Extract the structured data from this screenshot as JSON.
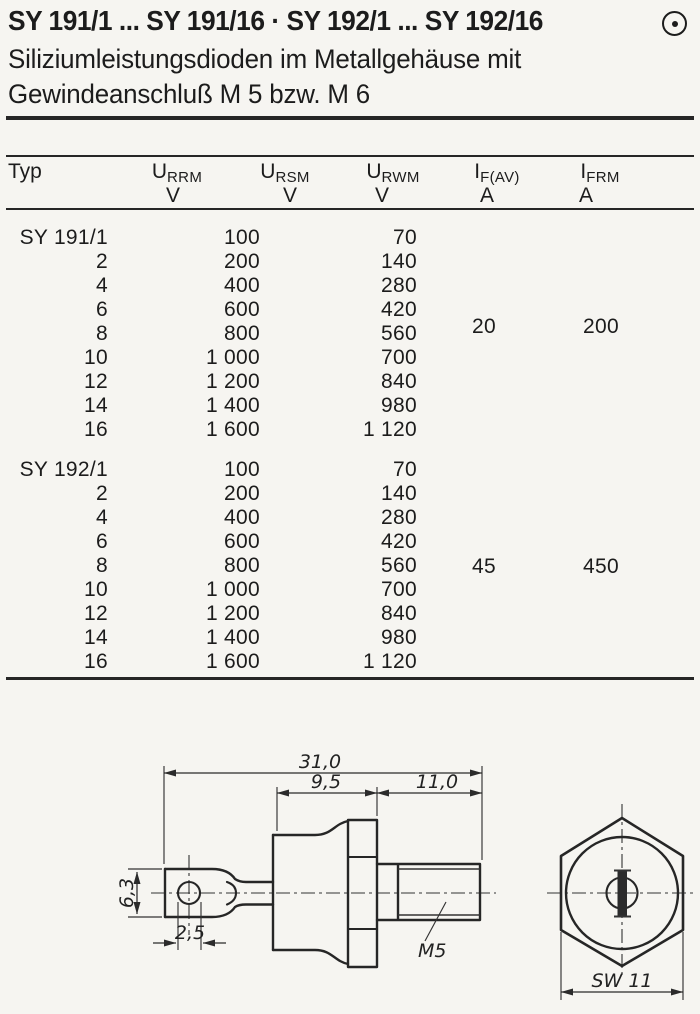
{
  "header": {
    "title": "SY 191/1 ... SY 191/16 · SY 192/1 ... SY 192/16",
    "subtitle_line1": "Siliziumleistungsdioden im Metallgehäuse mit",
    "subtitle_line2": "Gewindeanschluß M 5 bzw. M 6",
    "logo_icon": "circle-dot"
  },
  "table": {
    "columns": [
      {
        "label": "Typ",
        "base": "Typ",
        "sub": "",
        "unit": ""
      },
      {
        "base": "U",
        "sub": "RRM",
        "unit": "V"
      },
      {
        "base": "U",
        "sub": "RSM",
        "unit": "V"
      },
      {
        "base": "U",
        "sub": "RWM",
        "unit": "V"
      },
      {
        "base": "I",
        "sub": "F(AV)",
        "unit": "A"
      },
      {
        "base": "I",
        "sub": "FRM",
        "unit": "A"
      }
    ],
    "groups": [
      {
        "name": "SY 191",
        "if_av": "20",
        "ifrm": "200",
        "rows": [
          {
            "typ": "SY 191/1",
            "urrm": "100",
            "urwm": "70"
          },
          {
            "typ": "2",
            "urrm": "200",
            "urwm": "140"
          },
          {
            "typ": "4",
            "urrm": "400",
            "urwm": "280"
          },
          {
            "typ": "6",
            "urrm": "600",
            "urwm": "420"
          },
          {
            "typ": "8",
            "urrm": "800",
            "urwm": "560"
          },
          {
            "typ": "10",
            "urrm": "1 000",
            "urwm": "700"
          },
          {
            "typ": "12",
            "urrm": "1 200",
            "urwm": "840"
          },
          {
            "typ": "14",
            "urrm": "1 400",
            "urwm": "980"
          },
          {
            "typ": "16",
            "urrm": "1 600",
            "urwm": "1 120"
          }
        ]
      },
      {
        "name": "SY 192",
        "if_av": "45",
        "ifrm": "450",
        "rows": [
          {
            "typ": "SY 192/1",
            "urrm": "100",
            "urwm": "70"
          },
          {
            "typ": "2",
            "urrm": "200",
            "urwm": "140"
          },
          {
            "typ": "4",
            "urrm": "400",
            "urwm": "280"
          },
          {
            "typ": "6",
            "urrm": "600",
            "urwm": "420"
          },
          {
            "typ": "8",
            "urrm": "800",
            "urwm": "560"
          },
          {
            "typ": "10",
            "urrm": "1 000",
            "urwm": "700"
          },
          {
            "typ": "12",
            "urrm": "1 200",
            "urwm": "840"
          },
          {
            "typ": "14",
            "urrm": "1 400",
            "urwm": "980"
          },
          {
            "typ": "16",
            "urrm": "1 600",
            "urwm": "1 120"
          }
        ]
      }
    ]
  },
  "drawing": {
    "dim_overall": "31,0",
    "dim_body": "9,5",
    "dim_stud": "11,0",
    "dim_tab_height": "6,3",
    "dim_hole": "2,5",
    "thread_label": "M5",
    "wrench_label": "SW 11"
  }
}
